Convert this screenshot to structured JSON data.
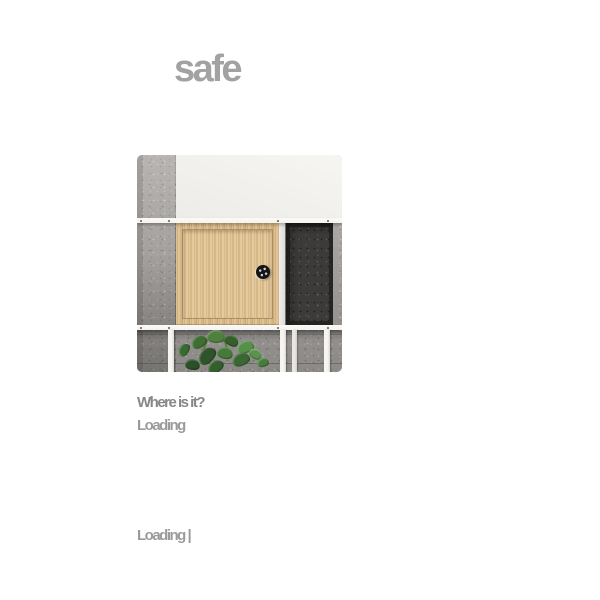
{
  "header": {
    "title": "safe"
  },
  "content": {
    "question": "Where is it?",
    "subtext": "Loading"
  },
  "footer": {
    "status": "Loading |"
  },
  "colors": {
    "title_text": "#a2a2a2",
    "question_text": "#878787",
    "subtext_text": "#9b9b9b",
    "status_text": "#9b9b9b",
    "page_background": "#ffffff",
    "concrete": "#aaa7a3",
    "wood": "#d9b987",
    "dark_panel": "#3c3b39",
    "shelf_white": "#f4f3f0",
    "leaf_green": "#417536"
  }
}
